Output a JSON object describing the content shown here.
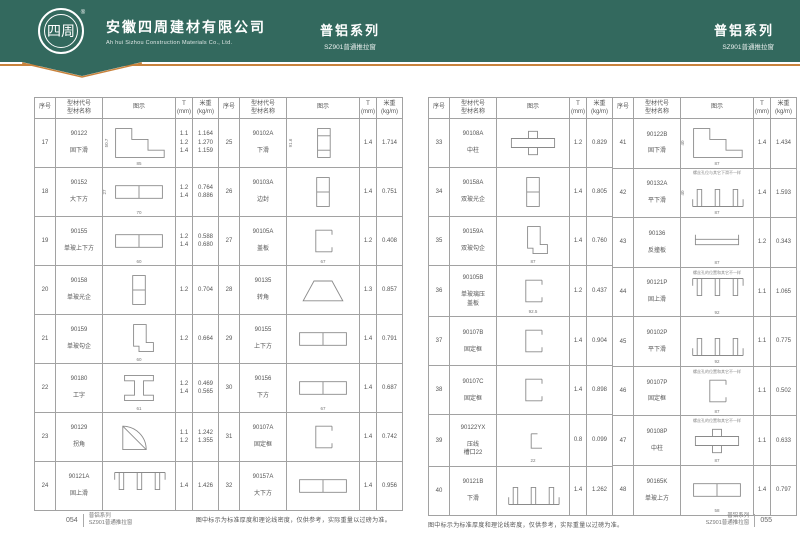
{
  "header": {
    "logo_text": "四周",
    "registered_mark": "®",
    "company_cn": "安徽四周建材有限公司",
    "company_en": "Ah hui Sizhou Construction Materials Co., Ltd.",
    "center_series": "普铝系列",
    "center_sub": "SZ901普通推拉窗",
    "right_series": "普铝系列",
    "right_sub": "SZ901普通推拉窗",
    "colors": {
      "header_bg": "#33695e",
      "accent": "#c8823c"
    }
  },
  "table": {
    "headers": {
      "no": "序号",
      "code_name": "型材代号\n型材名称",
      "diagram": "图示",
      "t": "T\n(mm)",
      "weight": "米重\n(kg/m)"
    }
  },
  "pages": [
    {
      "page_no": "054",
      "note": "图中标示为标准厚度和理论线密度，仅供参考，实际重量以过磅为准。",
      "footer_series": "普铝系列",
      "footer_sub": "SZ901普通推拉窗",
      "groups": [
        {
          "rows": [
            {
              "no": "17",
              "code": "90122",
              "name": "固下滑",
              "t": "1.1\n1.2\n1.4",
              "weight": "1.164\n1.270\n1.159",
              "shape": "step-rail",
              "dw": "85",
              "dh": "50.7",
              "note": ""
            },
            {
              "no": "18",
              "code": "90152",
              "name": "大下方",
              "t": "1.2\n1.4",
              "weight": "0.764\n0.886",
              "shape": "box-h",
              "dw": "70",
              "dh": "27",
              "note": ""
            },
            {
              "no": "19",
              "code": "90155",
              "name": "单玻上下方",
              "t": "1.2\n1.4",
              "weight": "0.588\n0.680",
              "shape": "box-h",
              "dw": "60",
              "dh": "",
              "note": ""
            },
            {
              "no": "20",
              "code": "90158",
              "name": "单玻光企",
              "t": "1.2",
              "weight": "0.704",
              "shape": "box-v",
              "dw": "",
              "dh": "",
              "note": ""
            },
            {
              "no": "21",
              "code": "90159",
              "name": "单玻勾企",
              "t": "1.2",
              "weight": "0.664",
              "shape": "hook",
              "dw": "60",
              "dh": "",
              "note": ""
            },
            {
              "no": "22",
              "code": "90180",
              "name": "工字",
              "t": "1.2\n1.4",
              "weight": "0.469\n0.565",
              "shape": "i-beam",
              "dw": "61",
              "dh": "",
              "note": ""
            },
            {
              "no": "23",
              "code": "90129",
              "name": "拐角",
              "t": "1.1\n1.2",
              "weight": "1.242\n1.355",
              "shape": "fan",
              "dw": "",
              "dh": "",
              "note": ""
            },
            {
              "no": "24",
              "code": "90121A",
              "name": "固上滑",
              "t": "1.4",
              "weight": "1.426",
              "shape": "top-rail",
              "dw": "",
              "dh": "",
              "note": ""
            }
          ]
        },
        {
          "rows": [
            {
              "no": "25",
              "code": "90102A",
              "name": "下滑",
              "t": "1.4",
              "weight": "1.714",
              "shape": "edge",
              "dw": "",
              "dh": "91.6",
              "note": ""
            },
            {
              "no": "26",
              "code": "90103A",
              "name": "边封",
              "t": "1.4",
              "weight": "0.751",
              "shape": "box-v",
              "dw": "",
              "dh": "",
              "note": ""
            },
            {
              "no": "27",
              "code": "90105A",
              "name": "盖板",
              "t": "1.2",
              "weight": "0.408",
              "shape": "c-channel",
              "dw": "67",
              "dh": "",
              "note": ""
            },
            {
              "no": "28",
              "code": "90135",
              "name": "转角",
              "t": "1.3",
              "weight": "0.857",
              "shape": "poly",
              "dw": "",
              "dh": "",
              "note": ""
            },
            {
              "no": "29",
              "code": "90155",
              "name": "上下方",
              "t": "1.4",
              "weight": "0.791",
              "shape": "box-h",
              "dw": "",
              "dh": "",
              "note": ""
            },
            {
              "no": "30",
              "code": "90156",
              "name": "下方",
              "t": "1.4",
              "weight": "0.687",
              "shape": "box-h",
              "dw": "67",
              "dh": "",
              "note": ""
            },
            {
              "no": "31",
              "code": "90107A",
              "name": "固定框",
              "t": "1.4",
              "weight": "0.742",
              "shape": "c-channel",
              "dw": "",
              "dh": "",
              "note": ""
            },
            {
              "no": "32",
              "code": "90157A",
              "name": "大下方",
              "t": "1.4",
              "weight": "0.956",
              "shape": "box-h",
              "dw": "",
              "dh": "",
              "note": ""
            }
          ]
        }
      ]
    },
    {
      "page_no": "055",
      "note": "图中标示为标准厚度和理论线密度，仅供参考，实际重量以过磅为准。",
      "footer_series": "普铝系列",
      "footer_sub": "SZ901普通推拉窗",
      "groups": [
        {
          "rows": [
            {
              "no": "33",
              "code": "90108A",
              "name": "中柱",
              "t": "1.2",
              "weight": "0.829",
              "shape": "t-section",
              "dw": "",
              "dh": "",
              "note": ""
            },
            {
              "no": "34",
              "code": "90158A",
              "name": "双玻光企",
              "t": "1.4",
              "weight": "0.805",
              "shape": "box-v",
              "dw": "",
              "dh": "",
              "note": ""
            },
            {
              "no": "35",
              "code": "90159A",
              "name": "双玻勾企",
              "t": "1.4",
              "weight": "0.760",
              "shape": "hook",
              "dw": "87",
              "dh": "",
              "note": ""
            },
            {
              "no": "36",
              "code": "90105B",
              "name": "单玻璃压\n盖板",
              "t": "1.2",
              "weight": "0.437",
              "shape": "c-channel",
              "dw": "92.5",
              "dh": "",
              "note": ""
            },
            {
              "no": "37",
              "code": "90107B",
              "name": "固定框",
              "t": "1.4",
              "weight": "0.904",
              "shape": "c-channel",
              "dw": "",
              "dh": "",
              "note": ""
            },
            {
              "no": "38",
              "code": "90107C",
              "name": "固定框",
              "t": "1.4",
              "weight": "0.898",
              "shape": "c-channel",
              "dw": "",
              "dh": "",
              "note": ""
            },
            {
              "no": "39",
              "code": "90122YX",
              "name": "压线\n槽口22",
              "t": "0.8",
              "weight": "0.099",
              "shape": "small-l",
              "dw": "22",
              "dh": "",
              "note": ""
            },
            {
              "no": "40",
              "code": "90121B",
              "name": "下滑",
              "t": "1.4",
              "weight": "1.262",
              "shape": "rail3",
              "dw": "",
              "dh": "",
              "note": ""
            }
          ]
        },
        {
          "rows": [
            {
              "no": "41",
              "code": "90122B",
              "name": "固下滑",
              "t": "1.4",
              "weight": "1.434",
              "shape": "step-rail",
              "dw": "87",
              "dh": "40",
              "note": ""
            },
            {
              "no": "42",
              "code": "90132A",
              "name": "平下滑",
              "t": "1.4",
              "weight": "1.593",
              "shape": "rail3",
              "dw": "87",
              "dh": "40",
              "note": "螺丝孔位与其它下滑不一样"
            },
            {
              "no": "43",
              "code": "90136",
              "name": "反撞板",
              "t": "1.2",
              "weight": "0.343",
              "shape": "flat",
              "dw": "87",
              "dh": "",
              "note": ""
            },
            {
              "no": "44",
              "code": "90121P",
              "name": "固上滑",
              "t": "1.1",
              "weight": "1.065",
              "shape": "top-rail",
              "dw": "92",
              "dh": "",
              "note": "螺丝孔的位置和其它不一样"
            },
            {
              "no": "45",
              "code": "90102P",
              "name": "平下滑",
              "t": "1.1",
              "weight": "0.775",
              "shape": "rail3",
              "dw": "92",
              "dh": "",
              "note": ""
            },
            {
              "no": "46",
              "code": "90107P",
              "name": "固定框",
              "t": "1.1",
              "weight": "0.502",
              "shape": "c-channel",
              "dw": "87",
              "dh": "",
              "note": "螺丝孔的位置和其它不一样"
            },
            {
              "no": "47",
              "code": "90108P",
              "name": "中柱",
              "t": "1.1",
              "weight": "0.633",
              "shape": "t-section",
              "dw": "87",
              "dh": "",
              "note": "螺丝孔的位置和其它不一样"
            },
            {
              "no": "48",
              "code": "90165K",
              "name": "单玻上方",
              "t": "1.4",
              "weight": "0.797",
              "shape": "box-h",
              "dw": "58",
              "dh": "",
              "note": ""
            }
          ]
        }
      ]
    }
  ]
}
